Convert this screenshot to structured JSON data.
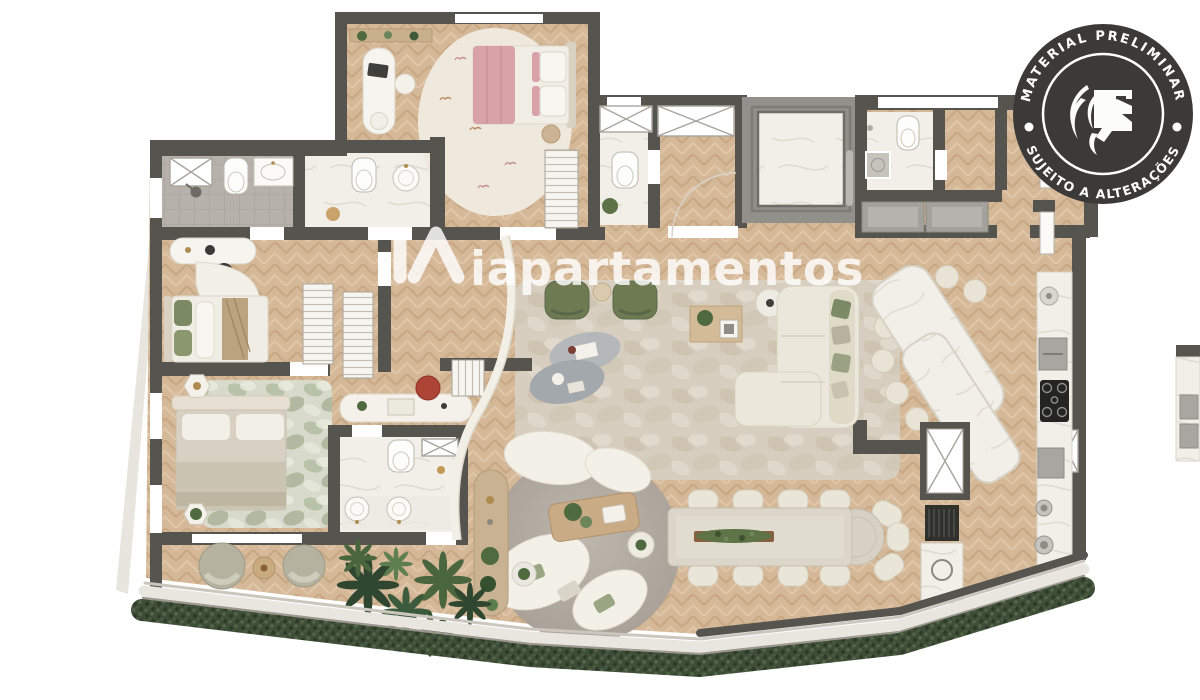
{
  "watermark": {
    "logo_icon": "ia-monogram-icon",
    "text": "iapartamentos",
    "color": "#ffffff",
    "opacity": 0.82
  },
  "stamp": {
    "shape": "circular-seal",
    "top_text": "MATERIAL PRELIMINAR",
    "bottom_text": "SUJEITO A ALTERAÇÕES",
    "icon": "lion-flame-crest-icon",
    "background": "#3b3a38",
    "text_color": "#ffffff"
  },
  "palette": {
    "background": "#ffffff",
    "wall": "#55544e",
    "wood_floor": "#d5b897",
    "wood_grain": "#c9a884",
    "marble_floor": "#f1efe8",
    "tile_floor": "#b6b2ab",
    "living_rug": "#d7cec0",
    "round_rug": "#b3aba1",
    "bedroom_rug": "#d8dacb",
    "sofa_beige": "#ece8db",
    "armchair_green": "#6e7b52",
    "bed_pink": "#d9a2a8",
    "chair_red": "#ad4435",
    "plant_green": "#4f6a3f",
    "hedge_green": "#3f4e37",
    "walkway": "#e9e6e0",
    "counter_gray": "#a3a19b",
    "appliance_black": "#2e2d2b"
  }
}
